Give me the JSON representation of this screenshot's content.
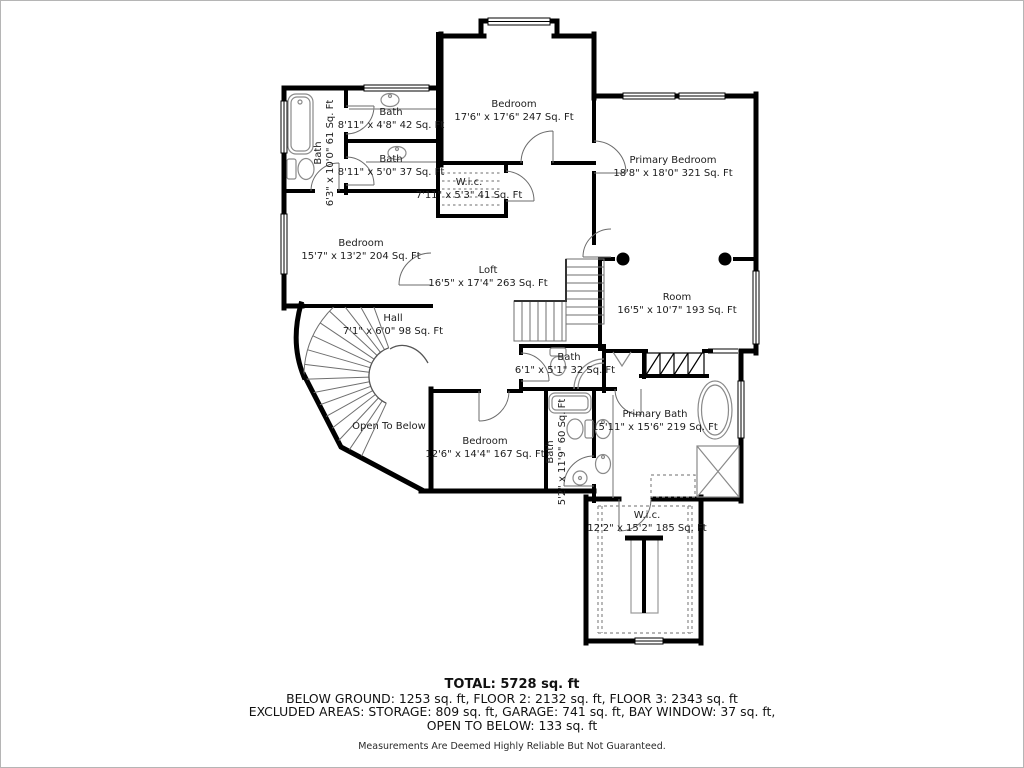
{
  "plan": {
    "rooms": {
      "bath_tl": {
        "name": "Bath",
        "dims": "6'3\" x 10'0\" 61 Sq. Ft"
      },
      "bath_top_a": {
        "name": "Bath",
        "dims": "8'11\" x 4'8\" 42 Sq. Ft"
      },
      "bath_top_b": {
        "name": "Bath",
        "dims": "8'11\" x 5'0\" 37 Sq. Ft"
      },
      "wic_top": {
        "name": "W.i.c.",
        "dims": "7'11\" x 5'3\" 41 Sq. Ft"
      },
      "bedroom_top": {
        "name": "Bedroom",
        "dims": "17'6\" x 17'6\" 247 Sq. Ft"
      },
      "primary_bedroom": {
        "name": "Primary Bedroom",
        "dims": "18'8\" x 18'0\" 321 Sq. Ft"
      },
      "bedroom_left": {
        "name": "Bedroom",
        "dims": "15'7\" x 13'2\" 204 Sq. Ft"
      },
      "loft": {
        "name": "Loft",
        "dims": "16'5\" x 17'4\" 263 Sq. Ft"
      },
      "hall": {
        "name": "Hall",
        "dims": "7'1\" x 6'0\" 98 Sq. Ft"
      },
      "room": {
        "name": "Room",
        "dims": "16'5\" x 10'7\" 193 Sq. Ft"
      },
      "open_to_below": {
        "name": "Open To Below"
      },
      "bath_center": {
        "name": "Bath",
        "dims": "6'1\" x 5'1\" 32 Sq. Ft"
      },
      "bedroom_bottom": {
        "name": "Bedroom",
        "dims": "12'6\" x 14'4\" 167 Sq. Ft"
      },
      "bath_lower": {
        "name": "Bath",
        "dims": "5'2\" x 11'9\" 60 Sq. Ft"
      },
      "primary_bath": {
        "name": "Primary Bath",
        "dims": "15'11\" x 15'6\" 219 Sq. Ft"
      },
      "wic_lower": {
        "name": "W.i.c.",
        "dims": "12'2\" x 15'2\" 185 Sq. Ft"
      }
    }
  },
  "summary": {
    "total": "TOTAL: 5728 sq. ft",
    "floors": "BELOW GROUND: 1253 sq. ft, FLOOR 2: 2132 sq. ft, FLOOR 3: 2343 sq. ft",
    "excluded1": "EXCLUDED AREAS: STORAGE: 809 sq. ft, GARAGE: 741 sq. ft, BAY WINDOW: 37 sq. ft,",
    "excluded2": "OPEN TO BELOW: 133 sq. ft",
    "disclaimer": "Measurements Are Deemed Highly Reliable But Not Guaranteed."
  },
  "colors": {
    "wall": "#000000",
    "fixture": "#8a8a8a",
    "door": "#6b6b6b"
  }
}
